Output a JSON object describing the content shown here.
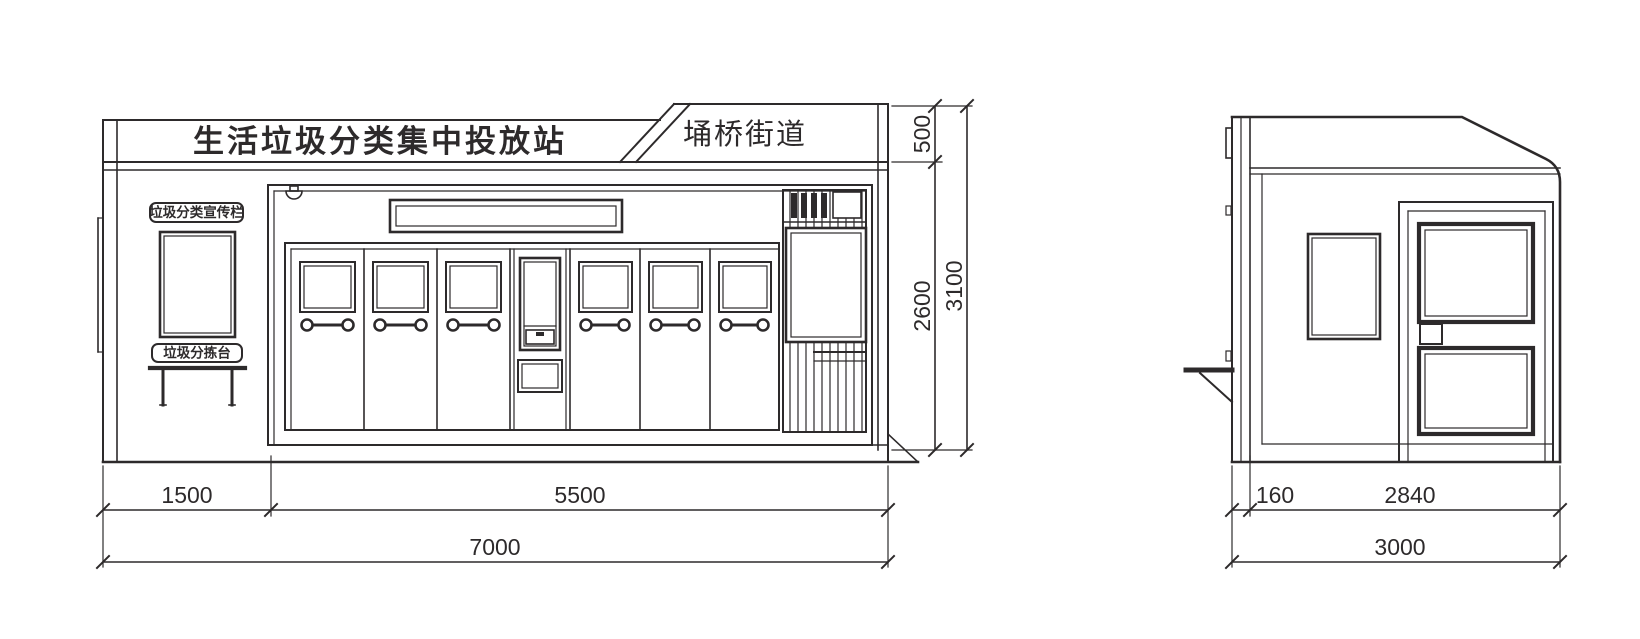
{
  "front_elevation": {
    "signboard": {
      "title": "生活垃圾分类集中投放站",
      "district": "埇桥街道"
    },
    "labels": {
      "publicity_board": "垃圾分类宣传栏",
      "sorting_table": "垃圾分拣台"
    },
    "dimensions": {
      "band_height_mm": "500",
      "body_height_mm": "2600",
      "total_height_mm": "3100",
      "left_bay_width_mm": "1500",
      "center_bay_width_mm": "5500",
      "total_width_mm": "7000"
    }
  },
  "side_elevation": {
    "dimensions": {
      "fascia_depth_mm": "160",
      "body_depth_mm": "2840",
      "total_depth_mm": "3000"
    }
  },
  "colors": {
    "line": "#2d2a2b",
    "background": "#ffffff"
  }
}
